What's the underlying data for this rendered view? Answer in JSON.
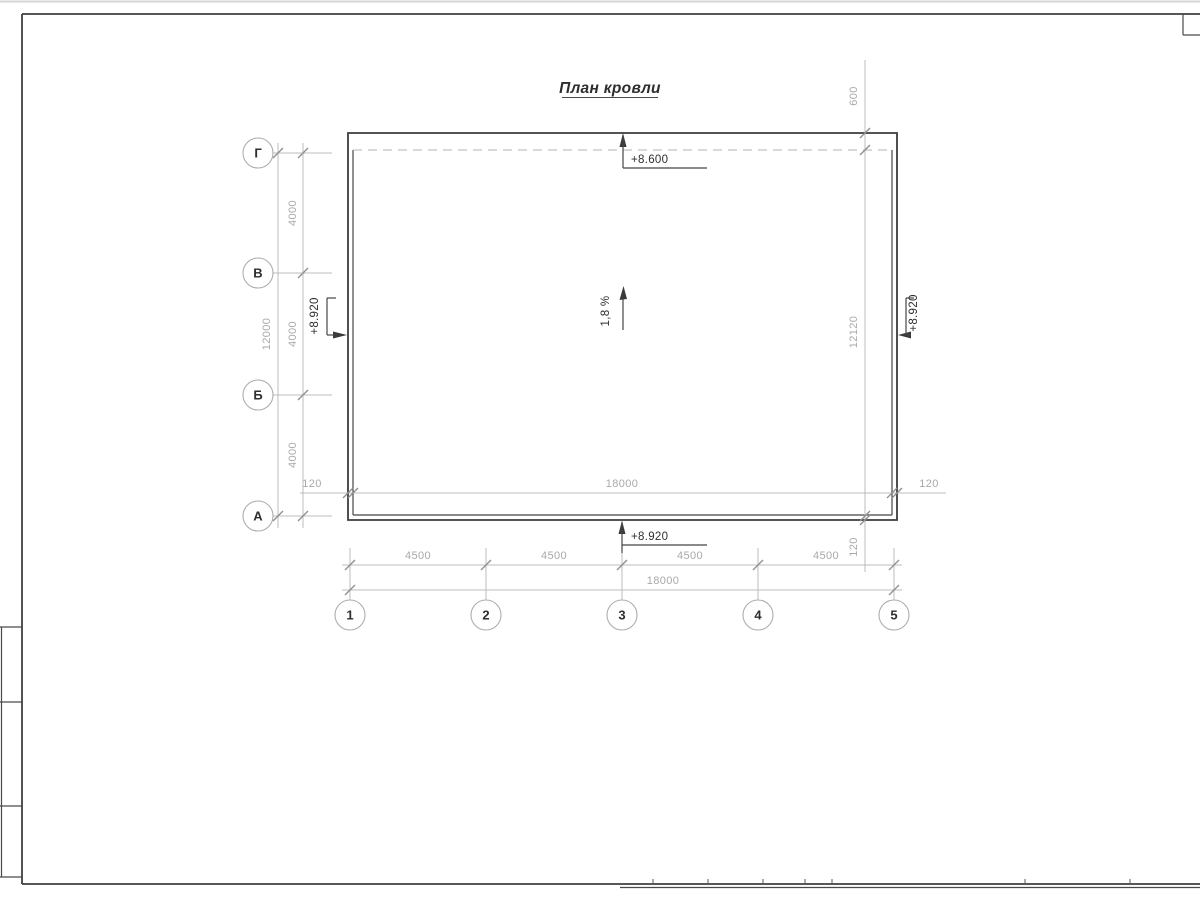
{
  "title": "План кровли",
  "colors": {
    "building_line": "#3c3c3c",
    "dimension_line": "#bcbcbc",
    "dimension_text": "#a9a9a9",
    "dark_text": "#2e2e2e"
  },
  "axes": {
    "rows": [
      {
        "label": "Г"
      },
      {
        "label": "В"
      },
      {
        "label": "Б"
      },
      {
        "label": "А"
      }
    ],
    "cols": [
      {
        "label": "1"
      },
      {
        "label": "2"
      },
      {
        "label": "3"
      },
      {
        "label": "4"
      },
      {
        "label": "5"
      }
    ]
  },
  "dims": {
    "left_segments": [
      "4000",
      "4000",
      "4000"
    ],
    "left_total": "12000",
    "bottom_segments": [
      "4500",
      "4500",
      "4500",
      "4500"
    ],
    "bottom_total": "18000",
    "inner_width": "18000",
    "inner_left_offset": "120",
    "inner_right_offset": "120",
    "right_top": "600",
    "right_total": "12120",
    "right_bottom_offset": "120"
  },
  "elevations": {
    "top": "+8.600",
    "bottom": "+8.920",
    "left": "+8.920",
    "right": "+8.920"
  },
  "slope": "1,8 %"
}
